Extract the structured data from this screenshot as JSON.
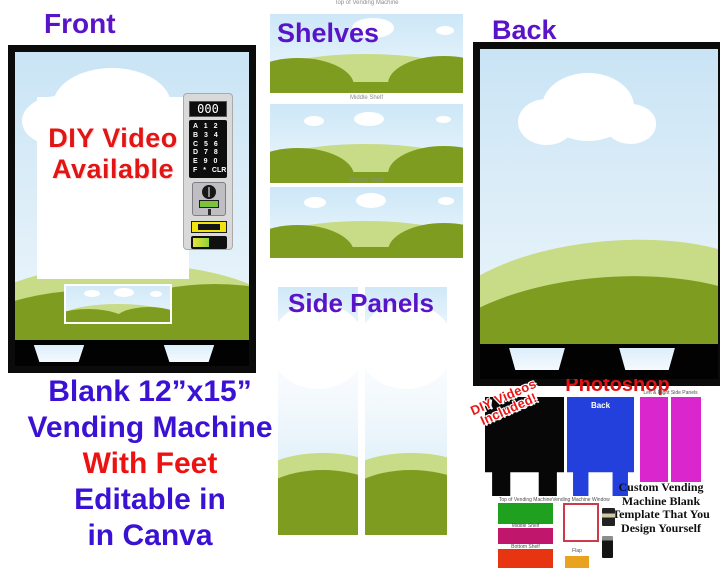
{
  "headings": {
    "front": "Front",
    "shelves": "Shelves",
    "back": "Back",
    "side_panels": "Side Panels",
    "photoshop": "Photoshop"
  },
  "front_machine": {
    "sign_lines": [
      "DIY Video",
      "Available"
    ],
    "display": "000",
    "keypad_rows": [
      "A 1 2",
      "B 3 4",
      "C 5 6",
      "D 7 8",
      "E 9 0",
      "F * CLR"
    ]
  },
  "shelves": {
    "top_label": "Top of Vending Machine",
    "middle_label": "Middle Shelf",
    "bottom_label": "Bottom Shelf"
  },
  "caption": {
    "lines": [
      "Blank 12”x15”",
      "Vending Machine",
      "With Feet",
      "Editable in",
      "in Canva"
    ]
  },
  "photoshop": {
    "sticker_lines": [
      "DIY Videos",
      "Included!"
    ],
    "blue_machine_label": "Back",
    "side_panels_label": "Left & Right Side Panels",
    "description_lines": [
      "Custom Vending",
      "Machine Blank",
      "Template That You",
      "Design Yourself"
    ],
    "swatch_labels": [
      "Top of Vending Machine",
      "Middle Shelf",
      "Bottom Shelf"
    ],
    "window_label": "Vending Machine Window",
    "flap_label": "Flap"
  },
  "colors": {
    "heading_purple": "#5a14c8",
    "caption_blue": "#3b12d4",
    "accent_red": "#e81212",
    "sky_light": "#cde7f7",
    "hill_light": "#c8db86",
    "hill_dark": "#7e9d20",
    "machine_blue": "#2340dd",
    "panel_pink": "#d926cd",
    "swatch_green": "#1fa01f",
    "swatch_magenta": "#c0166c",
    "swatch_red": "#e63510",
    "flap_orange": "#e9a321"
  }
}
